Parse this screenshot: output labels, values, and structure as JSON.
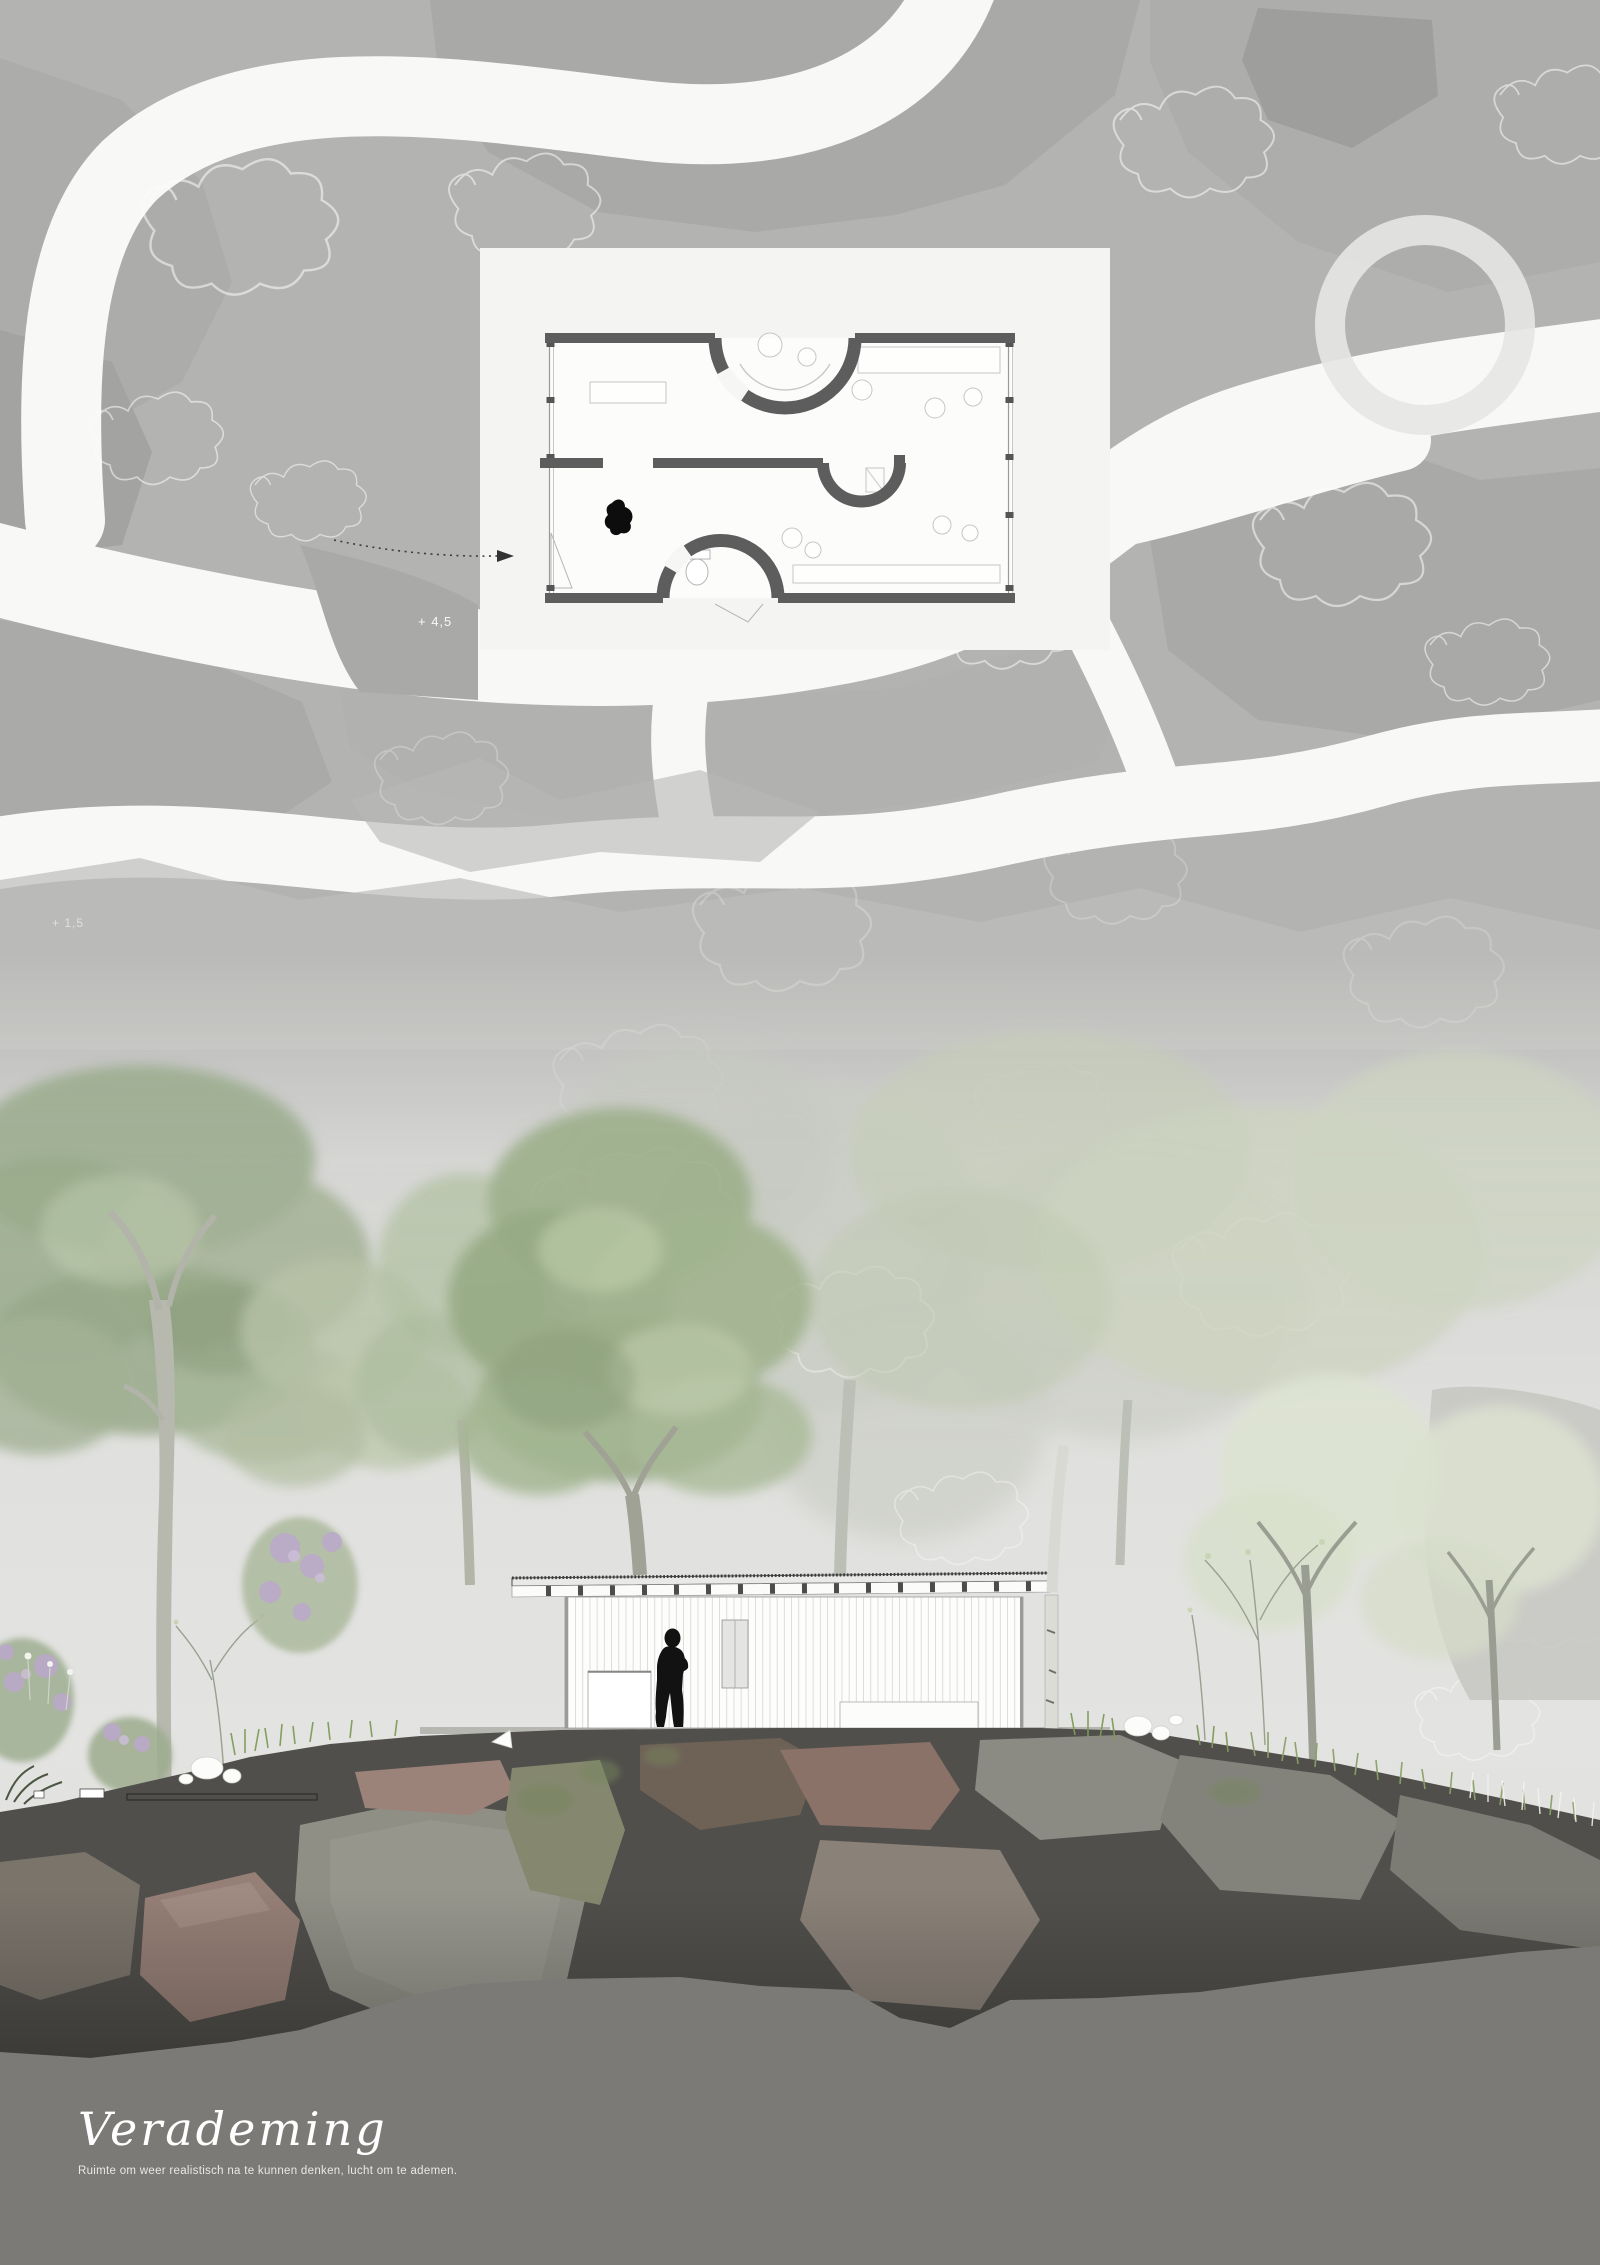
{
  "title_block": {
    "title": "Verademing",
    "subtitle": "Ruimte om weer realistisch na te kunnen denken, lucht om te ademen."
  },
  "site_plan": {
    "spot_elevations": {
      "upper": "+ 4,5",
      "lower": "+ 1,5"
    }
  },
  "icons": {
    "person": "person-silhouette",
    "bird": "bird-silhouette",
    "arrow": "entry-route-arrow"
  },
  "palette": {
    "site_base": "#b3b3b2",
    "site_blob": "#a7a7a5",
    "path_white": "#f8f8f7",
    "panel_white": "#f4f4f3",
    "plan_wall": "#5d5d5d",
    "mist": "#dcdcda",
    "foliage_green": "#9db08c",
    "foliage_pale": "#dde3d2",
    "tree_gray": "#c9ccc4",
    "ground_dark": "#504f4b",
    "rock_pink": "#957f76",
    "rock_gray": "#8f8f86",
    "bottom_fill": "#7b7a77",
    "silhouette_black": "#141414"
  }
}
